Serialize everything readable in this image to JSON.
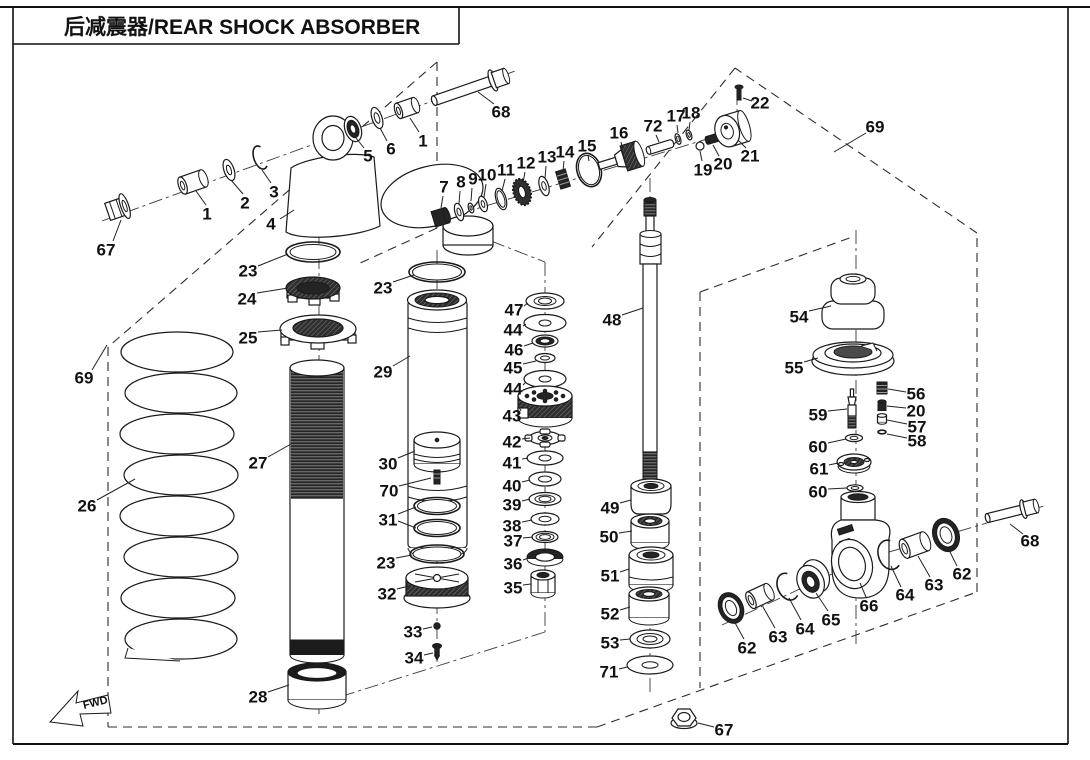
{
  "page": {
    "title": "后减震器/REAR SHOCK ABSORBER",
    "fwd_label": "FWD"
  },
  "colors": {
    "line": "#1a1a1a",
    "background": "#ffffff"
  },
  "labels": [
    {
      "t": "67",
      "x": 106,
      "y": 250,
      "leads": [
        [
          113,
          241,
          121,
          220
        ]
      ]
    },
    {
      "t": "1",
      "x": 207,
      "y": 214,
      "leads": [
        [
          206,
          205,
          196,
          191
        ]
      ]
    },
    {
      "t": "2",
      "x": 245,
      "y": 203,
      "leads": [
        [
          243,
          194,
          231,
          180
        ]
      ]
    },
    {
      "t": "3",
      "x": 274,
      "y": 192,
      "leads": [
        [
          271,
          183,
          262,
          170
        ]
      ]
    },
    {
      "t": "4",
      "x": 271,
      "y": 224,
      "leads": [
        [
          280,
          219,
          294,
          210
        ]
      ]
    },
    {
      "t": "5",
      "x": 368,
      "y": 156,
      "leads": [
        [
          364,
          148,
          356,
          138
        ]
      ]
    },
    {
      "t": "6",
      "x": 391,
      "y": 149,
      "leads": [
        [
          387,
          141,
          380,
          128
        ]
      ]
    },
    {
      "t": "1",
      "x": 423,
      "y": 141,
      "leads": [
        [
          419,
          132,
          410,
          118
        ]
      ]
    },
    {
      "t": "68",
      "x": 501,
      "y": 112,
      "leads": [
        [
          494,
          104,
          478,
          92
        ]
      ]
    },
    {
      "t": "7",
      "x": 444,
      "y": 187,
      "leads": [
        [
          443,
          196,
          441,
          208
        ]
      ]
    },
    {
      "t": "8",
      "x": 461,
      "y": 182,
      "leads": [
        [
          460,
          191,
          459,
          204
        ]
      ]
    },
    {
      "t": "9",
      "x": 473,
      "y": 179,
      "leads": [
        [
          472,
          188,
          471,
          201
        ]
      ]
    },
    {
      "t": "10",
      "x": 487,
      "y": 175,
      "leads": [
        [
          486,
          184,
          484,
          197
        ]
      ]
    },
    {
      "t": "11",
      "x": 506,
      "y": 170,
      "leads": [
        [
          505,
          179,
          502,
          191
        ]
      ]
    },
    {
      "t": "12",
      "x": 526,
      "y": 163,
      "leads": [
        [
          525,
          172,
          523,
          183
        ]
      ]
    },
    {
      "t": "13",
      "x": 547,
      "y": 157,
      "leads": [
        [
          546,
          166,
          545,
          178
        ]
      ]
    },
    {
      "t": "14",
      "x": 565,
      "y": 152,
      "leads": [
        [
          564,
          161,
          563,
          171
        ]
      ]
    },
    {
      "t": "15",
      "x": 587,
      "y": 146,
      "leads": [
        [
          588,
          155,
          589,
          161
        ]
      ]
    },
    {
      "t": "16",
      "x": 619,
      "y": 133,
      "leads": [
        [
          621,
          142,
          623,
          150
        ]
      ]
    },
    {
      "t": "72",
      "x": 653,
      "y": 126,
      "leads": [
        [
          656,
          135,
          659,
          142
        ]
      ]
    },
    {
      "t": "17",
      "x": 676,
      "y": 116,
      "leads": [
        [
          677,
          125,
          678,
          133
        ]
      ]
    },
    {
      "t": "18",
      "x": 691,
      "y": 113,
      "leads": [
        [
          690,
          122,
          689,
          130
        ]
      ]
    },
    {
      "t": "19",
      "x": 703,
      "y": 170,
      "leads": [
        [
          702,
          161,
          700,
          151
        ]
      ]
    },
    {
      "t": "20",
      "x": 723,
      "y": 164,
      "leads": [
        [
          719,
          156,
          713,
          145
        ]
      ]
    },
    {
      "t": "21",
      "x": 750,
      "y": 156,
      "leads": [
        [
          746,
          148,
          738,
          140
        ]
      ]
    },
    {
      "t": "22",
      "x": 760,
      "y": 103,
      "leads": [
        [
          752,
          101,
          743,
          98
        ]
      ]
    },
    {
      "t": "69",
      "x": 875,
      "y": 127,
      "leads": [
        [
          866,
          133,
          834,
          152
        ]
      ]
    },
    {
      "t": "69",
      "x": 84,
      "y": 378,
      "leads": [
        [
          92,
          370,
          107,
          345
        ]
      ]
    },
    {
      "t": "26",
      "x": 87,
      "y": 506,
      "leads": [
        [
          97,
          500,
          135,
          479
        ]
      ]
    },
    {
      "t": "27",
      "x": 258,
      "y": 463,
      "leads": [
        [
          268,
          457,
          291,
          444
        ]
      ]
    },
    {
      "t": "23",
      "x": 248,
      "y": 271,
      "leads": [
        [
          258,
          266,
          288,
          254
        ]
      ]
    },
    {
      "t": "24",
      "x": 247,
      "y": 299,
      "leads": [
        [
          257,
          293,
          288,
          288
        ]
      ]
    },
    {
      "t": "25",
      "x": 248,
      "y": 338,
      "leads": [
        [
          258,
          332,
          282,
          330
        ]
      ]
    },
    {
      "t": "23",
      "x": 383,
      "y": 288,
      "leads": [
        [
          393,
          282,
          414,
          275
        ]
      ]
    },
    {
      "t": "29",
      "x": 383,
      "y": 372,
      "leads": [
        [
          393,
          366,
          410,
          356
        ]
      ]
    },
    {
      "t": "30",
      "x": 388,
      "y": 464,
      "leads": [
        [
          398,
          458,
          415,
          451
        ]
      ]
    },
    {
      "t": "70",
      "x": 389,
      "y": 491,
      "leads": [
        [
          399,
          486,
          431,
          478
        ]
      ]
    },
    {
      "t": "31",
      "x": 388,
      "y": 520,
      "leads": [
        [
          398,
          514,
          416,
          507
        ],
        [
          398,
          521,
          416,
          528
        ]
      ]
    },
    {
      "t": "23",
      "x": 386,
      "y": 563,
      "leads": [
        [
          396,
          558,
          412,
          555
        ]
      ]
    },
    {
      "t": "32",
      "x": 387,
      "y": 594,
      "leads": [
        [
          397,
          589,
          409,
          586
        ]
      ]
    },
    {
      "t": "33",
      "x": 413,
      "y": 632,
      "leads": [
        [
          423,
          629,
          432,
          627
        ]
      ]
    },
    {
      "t": "34",
      "x": 414,
      "y": 658,
      "leads": [
        [
          424,
          655,
          433,
          653
        ]
      ]
    },
    {
      "t": "28",
      "x": 258,
      "y": 697,
      "leads": [
        [
          268,
          692,
          289,
          685
        ]
      ]
    },
    {
      "t": "47",
      "x": 514,
      "y": 310,
      "leads": [
        [
          524,
          306,
          528,
          303
        ]
      ]
    },
    {
      "t": "44",
      "x": 513,
      "y": 330,
      "leads": [
        [
          523,
          326,
          526,
          324
        ]
      ]
    },
    {
      "t": "46",
      "x": 514,
      "y": 350,
      "leads": [
        [
          524,
          346,
          533,
          343
        ]
      ]
    },
    {
      "t": "45",
      "x": 513,
      "y": 368,
      "leads": [
        [
          523,
          364,
          536,
          361
        ]
      ]
    },
    {
      "t": "44",
      "x": 513,
      "y": 389,
      "leads": [
        [
          523,
          385,
          526,
          382
        ]
      ]
    },
    {
      "t": "43",
      "x": 512,
      "y": 416,
      "leads": [
        [
          521,
          411,
          519,
          407
        ]
      ]
    },
    {
      "t": "42",
      "x": 512,
      "y": 442,
      "leads": [
        [
          522,
          439,
          530,
          438
        ]
      ]
    },
    {
      "t": "41",
      "x": 512,
      "y": 463,
      "leads": [
        [
          522,
          459,
          528,
          458
        ]
      ]
    },
    {
      "t": "40",
      "x": 512,
      "y": 486,
      "leads": [
        [
          522,
          482,
          530,
          480
        ]
      ]
    },
    {
      "t": "39",
      "x": 512,
      "y": 505,
      "leads": [
        [
          522,
          501,
          530,
          499
        ]
      ]
    },
    {
      "t": "38",
      "x": 512,
      "y": 526,
      "leads": [
        [
          522,
          522,
          532,
          520
        ]
      ]
    },
    {
      "t": "37",
      "x": 513,
      "y": 541,
      "leads": [
        [
          523,
          538,
          533,
          537
        ]
      ]
    },
    {
      "t": "36",
      "x": 513,
      "y": 564,
      "leads": [
        [
          523,
          560,
          528,
          558
        ]
      ]
    },
    {
      "t": "35",
      "x": 513,
      "y": 588,
      "leads": [
        [
          523,
          585,
          531,
          584
        ]
      ]
    },
    {
      "t": "48",
      "x": 612,
      "y": 320,
      "leads": [
        [
          622,
          315,
          643,
          308
        ]
      ]
    },
    {
      "t": "49",
      "x": 610,
      "y": 508,
      "leads": [
        [
          620,
          503,
          631,
          500
        ]
      ]
    },
    {
      "t": "50",
      "x": 609,
      "y": 537,
      "leads": [
        [
          619,
          533,
          632,
          531
        ]
      ]
    },
    {
      "t": "51",
      "x": 610,
      "y": 576,
      "leads": [
        [
          620,
          572,
          629,
          569
        ]
      ]
    },
    {
      "t": "52",
      "x": 610,
      "y": 614,
      "leads": [
        [
          620,
          610,
          630,
          607
        ]
      ]
    },
    {
      "t": "53",
      "x": 610,
      "y": 643,
      "leads": [
        [
          620,
          640,
          630,
          639
        ]
      ]
    },
    {
      "t": "71",
      "x": 609,
      "y": 672,
      "leads": [
        [
          619,
          669,
          627,
          667
        ]
      ]
    },
    {
      "t": "54",
      "x": 799,
      "y": 317,
      "leads": [
        [
          809,
          311,
          831,
          306
        ]
      ]
    },
    {
      "t": "55",
      "x": 794,
      "y": 368,
      "leads": [
        [
          804,
          362,
          818,
          358
        ]
      ]
    },
    {
      "t": "59",
      "x": 818,
      "y": 415,
      "leads": [
        [
          828,
          411,
          847,
          409
        ]
      ]
    },
    {
      "t": "60",
      "x": 818,
      "y": 447,
      "leads": [
        [
          828,
          443,
          846,
          439
        ]
      ]
    },
    {
      "t": "61",
      "x": 819,
      "y": 469,
      "leads": [
        [
          829,
          465,
          838,
          463
        ]
      ]
    },
    {
      "t": "60",
      "x": 818,
      "y": 492,
      "leads": [
        [
          828,
          489,
          847,
          488
        ]
      ]
    },
    {
      "t": "56",
      "x": 916,
      "y": 394,
      "leads": [
        [
          906,
          392,
          888,
          389
        ]
      ]
    },
    {
      "t": "20",
      "x": 916,
      "y": 411,
      "leads": [
        [
          906,
          408,
          887,
          406
        ]
      ]
    },
    {
      "t": "57",
      "x": 917,
      "y": 427,
      "leads": [
        [
          907,
          424,
          887,
          420
        ]
      ]
    },
    {
      "t": "58",
      "x": 917,
      "y": 441,
      "leads": [
        [
          907,
          438,
          887,
          434
        ]
      ]
    },
    {
      "t": "66",
      "x": 869,
      "y": 606,
      "leads": [
        [
          866,
          597,
          860,
          583
        ]
      ]
    },
    {
      "t": "65",
      "x": 831,
      "y": 620,
      "leads": [
        [
          828,
          611,
          816,
          593
        ]
      ]
    },
    {
      "t": "64",
      "x": 805,
      "y": 629,
      "leads": [
        [
          801,
          620,
          789,
          598
        ]
      ]
    },
    {
      "t": "63",
      "x": 778,
      "y": 637,
      "leads": [
        [
          775,
          628,
          763,
          607
        ]
      ]
    },
    {
      "t": "62",
      "x": 747,
      "y": 648,
      "leads": [
        [
          744,
          639,
          734,
          621
        ]
      ]
    },
    {
      "t": "64",
      "x": 905,
      "y": 595,
      "leads": [
        [
          901,
          587,
          891,
          566
        ]
      ]
    },
    {
      "t": "63",
      "x": 934,
      "y": 585,
      "leads": [
        [
          930,
          577,
          918,
          556
        ]
      ]
    },
    {
      "t": "62",
      "x": 962,
      "y": 574,
      "leads": [
        [
          957,
          566,
          948,
          548
        ]
      ]
    },
    {
      "t": "68",
      "x": 1030,
      "y": 541,
      "leads": [
        [
          1023,
          534,
          1010,
          524
        ]
      ]
    },
    {
      "t": "67",
      "x": 724,
      "y": 730,
      "leads": [
        [
          714,
          727,
          698,
          723
        ]
      ]
    }
  ]
}
